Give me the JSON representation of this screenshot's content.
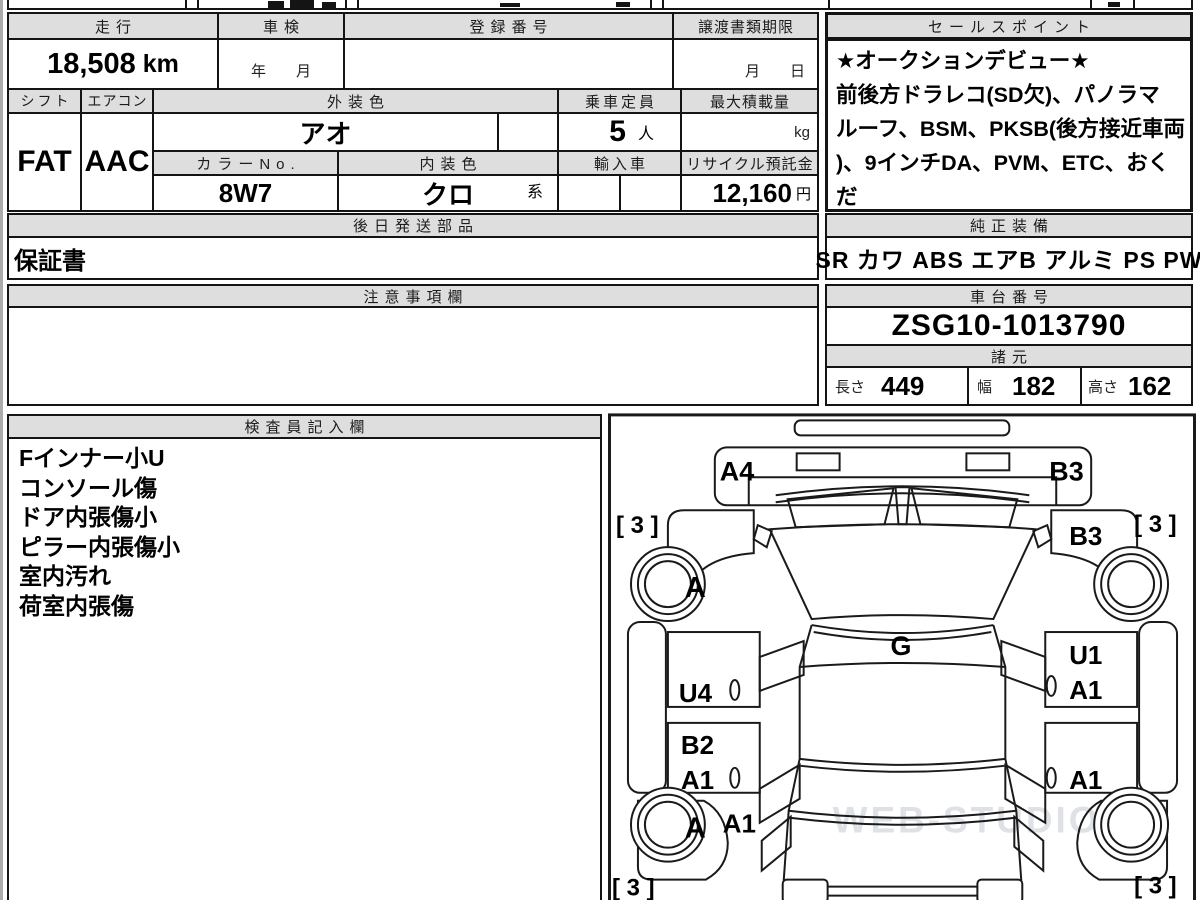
{
  "colors": {
    "header_bg": "#dedede",
    "line": "#141414",
    "watermark": "#d3d7dd"
  },
  "vehicle_table": {
    "mileage": {
      "label": "走行",
      "value": "18,508",
      "unit": "km"
    },
    "shaken": {
      "label": "車検",
      "placeholder": "年　　月"
    },
    "registration": {
      "label": "登録番号",
      "value": ""
    },
    "transfer_deadline": {
      "label": "譲渡書類期限",
      "placeholder": "月　　日"
    },
    "shift": {
      "label": "シフト",
      "value": "FAT"
    },
    "aircon": {
      "label": "エアコン",
      "value": "AAC"
    },
    "exterior_color": {
      "label": "外装色",
      "value": "アオ"
    },
    "capacity": {
      "label": "乗車定員",
      "value": "5",
      "unit": "人"
    },
    "max_load": {
      "label": "最大積載量",
      "value": "",
      "unit": "kg"
    },
    "color_no": {
      "label": "カラーNo.",
      "value": "8W7"
    },
    "interior_color": {
      "label": "内装色",
      "value": "クロ",
      "suffix": "系"
    },
    "import_car": {
      "label": "輸入車",
      "value": ""
    },
    "recycle_deposit": {
      "label": "リサイクル預託金",
      "value": "12,160",
      "unit": "円"
    }
  },
  "sales_point": {
    "label": "セールスポイント",
    "lines": [
      "★オークションデビュー★",
      "前後方ドラレコ(SD欠)、パノラマ",
      "ルーフ、BSM、PKSB(後方接近車両",
      ")、9インチDA、PVM、ETC、おくだ",
      "け充電"
    ]
  },
  "later_shipped_parts": {
    "label": "後日発送部品",
    "value": "保証書"
  },
  "genuine_equipment": {
    "label": "純正装備",
    "value": "SR カワ ABS エアB アルミ PS PW"
  },
  "cautions": {
    "label": "注意事項欄",
    "value": ""
  },
  "chassis_number": {
    "label": "車台番号",
    "value": "ZSG10-1013790"
  },
  "specs": {
    "label": "諸元",
    "length": {
      "label": "長さ",
      "value": "449"
    },
    "width": {
      "label": "幅",
      "value": "182"
    },
    "height": {
      "label": "高さ",
      "value": "162"
    }
  },
  "inspector_notes": {
    "label": "検査員記入欄",
    "lines": [
      "Fインナー小U",
      "コンソール傷",
      "ドア内張傷小",
      "ピラー内張傷小",
      "室内汚れ",
      "荷室内張傷"
    ]
  },
  "damage_diagram": {
    "front_bumper_left": "A4",
    "front_bumper_right": "B3",
    "tire_front_left": "[ 3 ]",
    "tire_front_right": "[ 3 ]",
    "tire_rear_left": "[ 3 ]",
    "tire_rear_right": "[ 3 ]",
    "wheel_front_left": "A",
    "wheel_rear_left": "A",
    "front_fender_right": "B3",
    "windshield": "G",
    "front_door_left": "U4",
    "front_door_right_1": "U1",
    "front_door_right_2": "A1",
    "rear_door_left_1": "B2",
    "rear_door_left_2": "A1",
    "rear_door_right": "A1",
    "rear_quarter_left": "A1",
    "watermark": "WEB-STUDIO.RU"
  }
}
